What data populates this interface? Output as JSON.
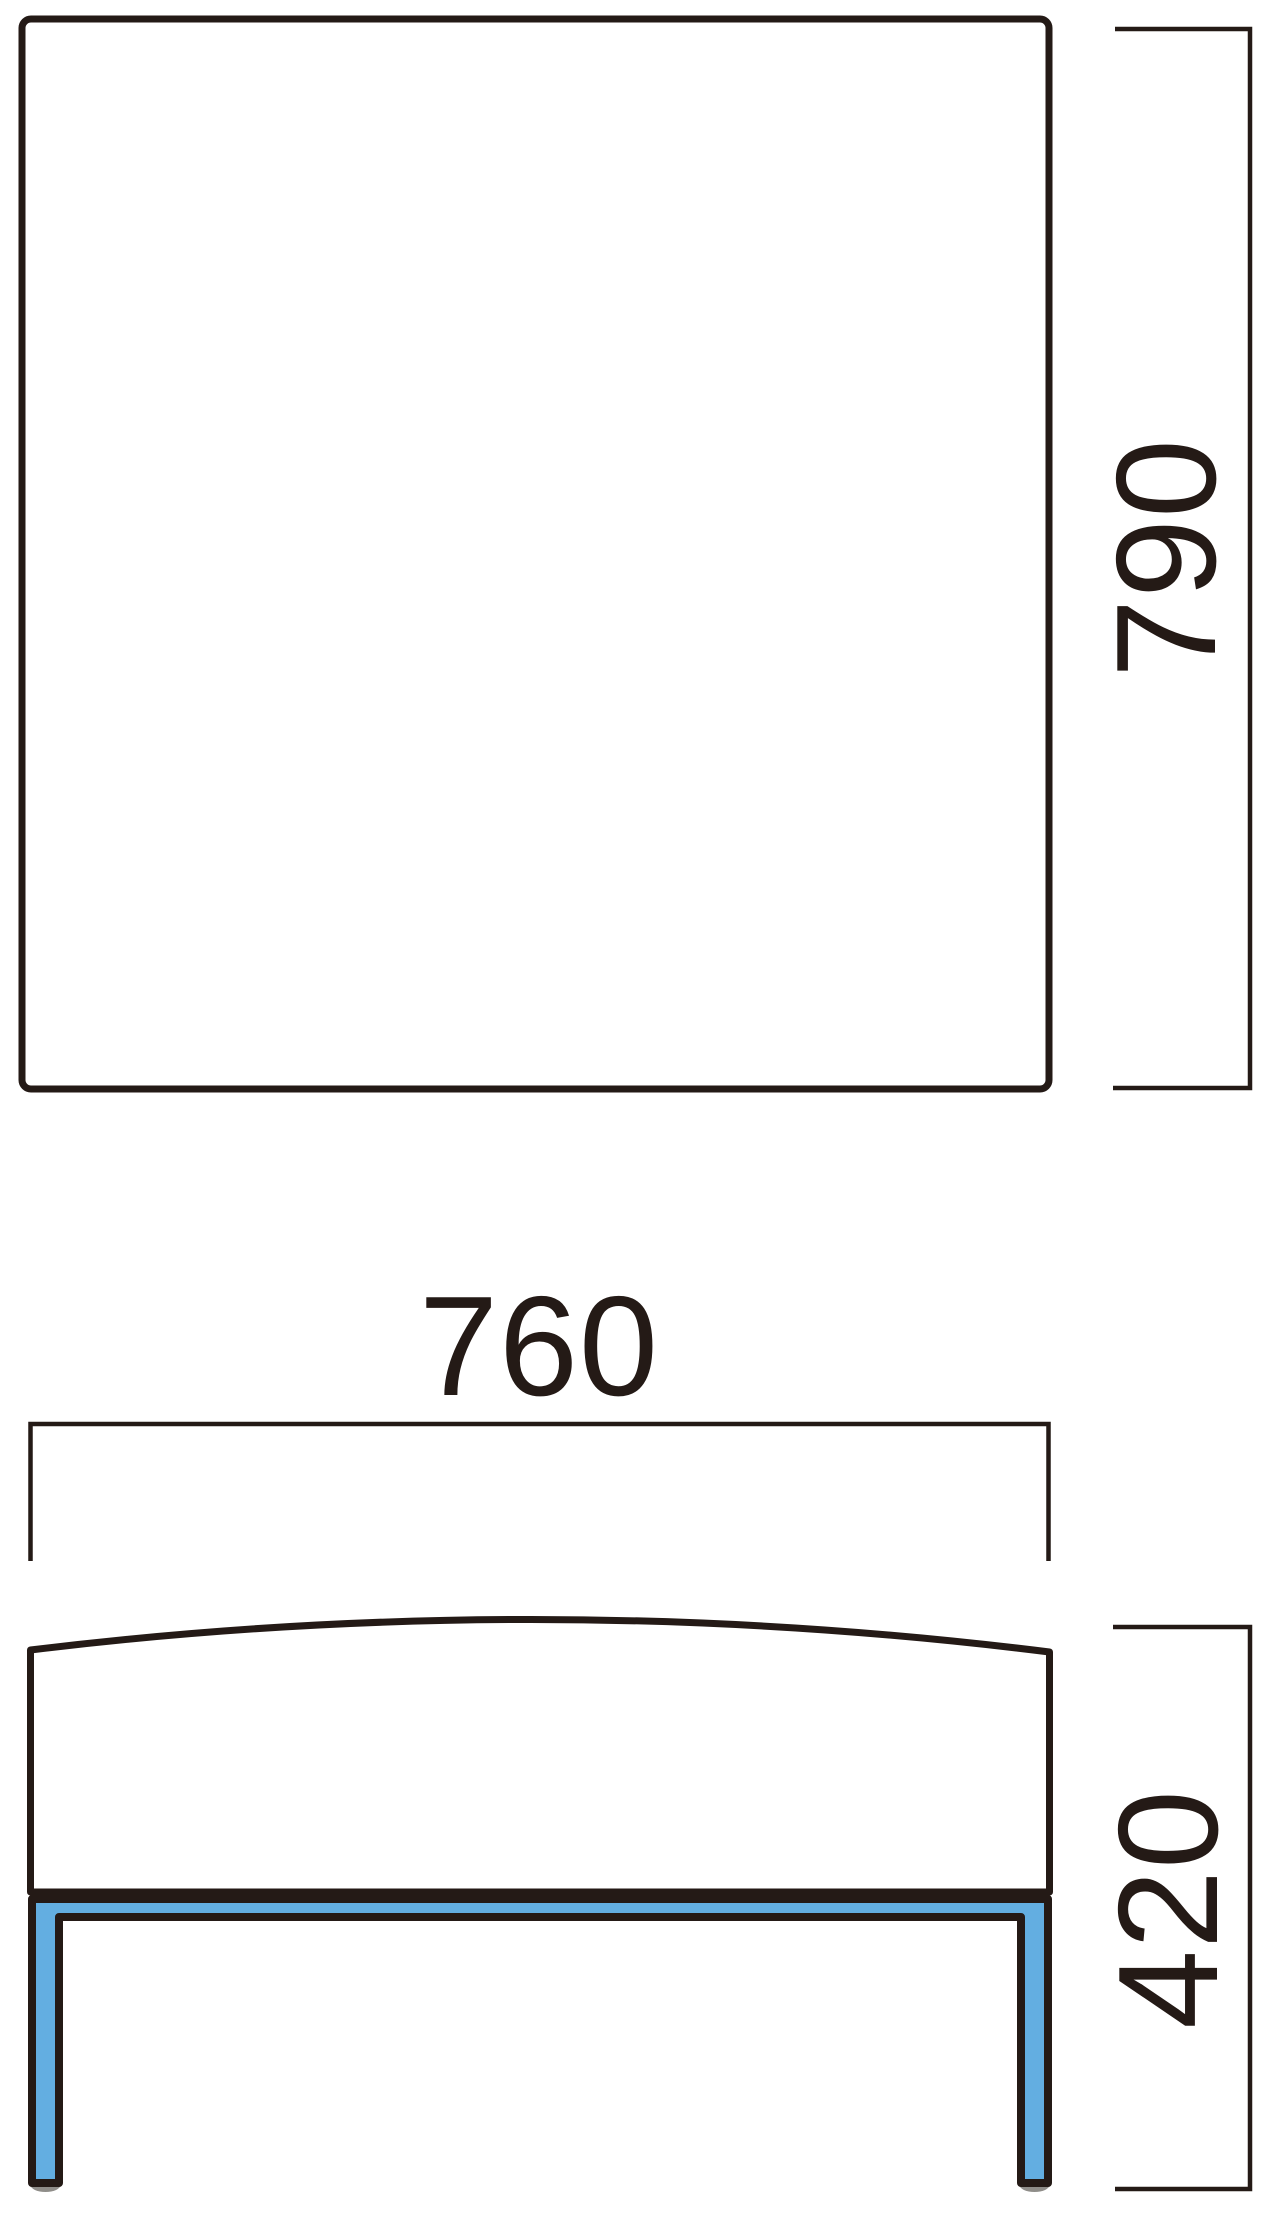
{
  "drawing": {
    "type": "furniture-dimension-diagram",
    "views": {
      "top_view": {
        "shape": "square-panel",
        "depth_dimension": {
          "label": "790",
          "orientation": "vertical"
        }
      },
      "front_view": {
        "shape": "bench-seat-with-legs",
        "width_dimension": {
          "label": "760",
          "orientation": "horizontal"
        },
        "height_dimension": {
          "label": "420",
          "orientation": "vertical"
        }
      }
    },
    "colors": {
      "ink": "#241a16",
      "leg_fill": "#63aee1",
      "foot_pad": "#8f8d89",
      "background": "#ffffff"
    }
  }
}
